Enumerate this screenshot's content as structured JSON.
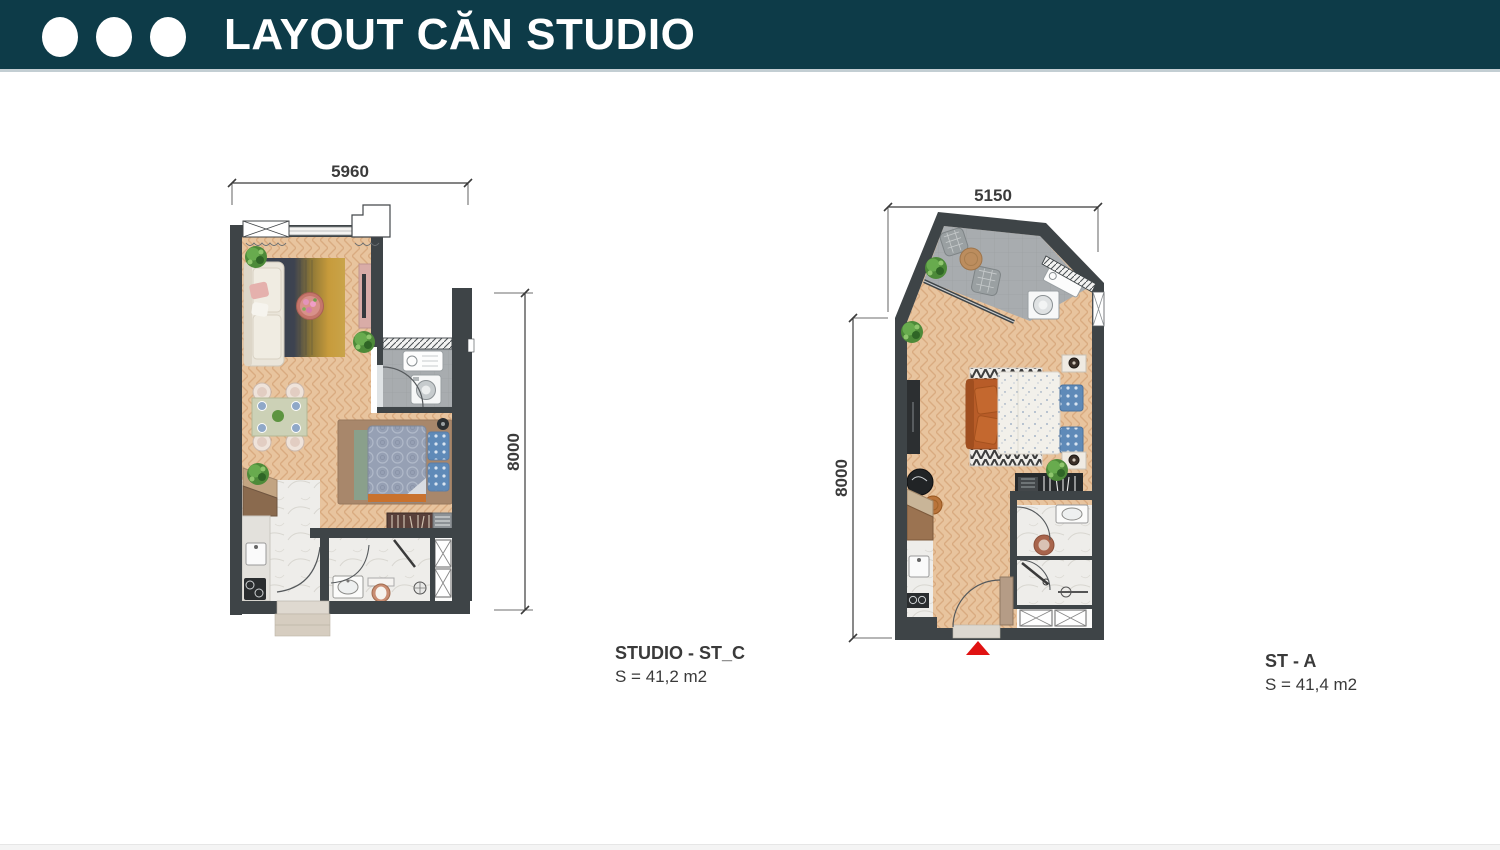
{
  "header": {
    "title": "LAYOUT CĂN STUDIO"
  },
  "plans": [
    {
      "name": "STUDIO - ST_C",
      "area": "S = 41,2 m2",
      "dims": {
        "width": "5960",
        "height": "8000"
      }
    },
    {
      "name": "ST - A",
      "area": "S = 41,4 m2",
      "dims": {
        "width": "5150",
        "height": "8000"
      }
    }
  ],
  "colors": {
    "header_bg": "#0d3b48",
    "header_divider": "#c3ced3",
    "wall": "#3e4447",
    "wood_floor": "#e8c49e",
    "balcony_floor": "#a8acaf",
    "marble_floor": "#eeedea",
    "rug_dark": "#394150",
    "rug_mustard": "#c79b3b",
    "sofa_cream": "#eae5da",
    "sofa_orange": "#b85c28",
    "entrance_arrow": "#e01212",
    "dimension_text": "#3b3b3b"
  }
}
